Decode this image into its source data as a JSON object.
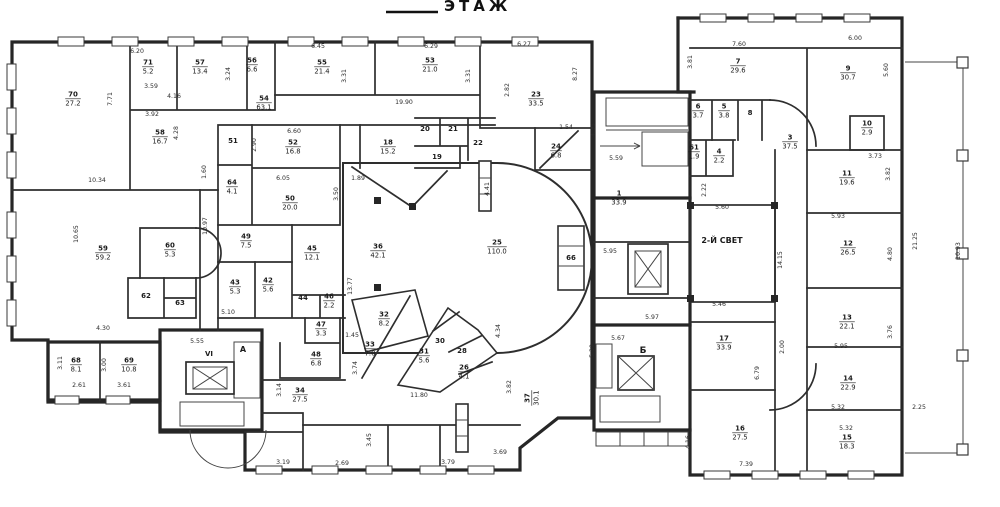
{
  "title": {
    "floor_label": "ЭТАЖ"
  },
  "colors": {
    "paper": "#ffffff",
    "ink": "#1b1b1b",
    "wall": "#262626"
  },
  "plan": {
    "annotation_note": "scanned floor plan; rooms are number/area fractions, dims in meters",
    "rooms": [
      {
        "n": "70",
        "a": "27.2",
        "x": 73,
        "y": 98
      },
      {
        "n": "71",
        "a": "5.2",
        "x": 148,
        "y": 66
      },
      {
        "n": "57",
        "a": "13.4",
        "x": 200,
        "y": 66
      },
      {
        "n": "56",
        "a": "6.6",
        "x": 252,
        "y": 64
      },
      {
        "n": "55",
        "a": "21.4",
        "x": 322,
        "y": 66
      },
      {
        "n": "53",
        "a": "21.0",
        "x": 430,
        "y": 64
      },
      {
        "n": "23",
        "a": "33.5",
        "x": 536,
        "y": 98
      },
      {
        "n": "54",
        "a": "63.1",
        "x": 264,
        "y": 102
      },
      {
        "n": "58",
        "a": "16.7",
        "x": 160,
        "y": 136
      },
      {
        "n": "51",
        "x": 233,
        "y": 140
      },
      {
        "n": "52",
        "a": "16.8",
        "x": 293,
        "y": 146
      },
      {
        "n": "18",
        "a": "15.2",
        "x": 388,
        "y": 146
      },
      {
        "n": "20",
        "x": 425,
        "y": 128
      },
      {
        "n": "21",
        "x": 453,
        "y": 128
      },
      {
        "n": "19",
        "x": 437,
        "y": 156
      },
      {
        "n": "22",
        "x": 478,
        "y": 142
      },
      {
        "n": "24",
        "a": "6.8",
        "x": 556,
        "y": 150
      },
      {
        "n": "64",
        "a": "4.1",
        "x": 232,
        "y": 186
      },
      {
        "n": "50",
        "a": "20.0",
        "x": 290,
        "y": 202
      },
      {
        "n": "49",
        "a": "7.5",
        "x": 246,
        "y": 240
      },
      {
        "n": "43",
        "a": "5.3",
        "x": 235,
        "y": 286
      },
      {
        "n": "42",
        "a": "5.6",
        "x": 268,
        "y": 284
      },
      {
        "n": "45",
        "a": "12.1",
        "x": 312,
        "y": 252
      },
      {
        "n": "44",
        "x": 303,
        "y": 297
      },
      {
        "n": "46",
        "a": "2.2",
        "x": 329,
        "y": 300
      },
      {
        "n": "47",
        "a": "3.3",
        "x": 321,
        "y": 328
      },
      {
        "n": "48",
        "a": "6.8",
        "x": 316,
        "y": 358
      },
      {
        "n": "36",
        "a": "42.1",
        "x": 378,
        "y": 250
      },
      {
        "n": "25",
        "a": "110.0",
        "x": 497,
        "y": 246
      },
      {
        "n": "59",
        "a": "59.2",
        "x": 103,
        "y": 252
      },
      {
        "n": "60",
        "a": "5.3",
        "x": 170,
        "y": 249
      },
      {
        "n": "62",
        "x": 146,
        "y": 295
      },
      {
        "n": "63",
        "x": 180,
        "y": 302
      },
      {
        "n": "68",
        "a": "8.1",
        "x": 76,
        "y": 364
      },
      {
        "n": "69",
        "a": "10.8",
        "x": 129,
        "y": 364
      },
      {
        "n": "34",
        "a": "27.5",
        "x": 300,
        "y": 394
      },
      {
        "n": "33",
        "a": "7.0",
        "x": 370,
        "y": 348
      },
      {
        "n": "32",
        "a": "8.2",
        "x": 384,
        "y": 318
      },
      {
        "n": "31",
        "a": "5.6",
        "x": 424,
        "y": 355
      },
      {
        "n": "30",
        "x": 440,
        "y": 340
      },
      {
        "n": "28",
        "x": 462,
        "y": 350
      },
      {
        "n": "26",
        "a": "4.1",
        "x": 464,
        "y": 371
      },
      {
        "n": "37",
        "a": "30.1",
        "x": 531,
        "y": 398,
        "r": -90
      },
      {
        "n": "66",
        "x": 571,
        "y": 257
      },
      {
        "n": "1",
        "a": "33.9",
        "x": 619,
        "y": 197
      },
      {
        "n": "17",
        "a": "33.9",
        "x": 724,
        "y": 342
      },
      {
        "n": "16",
        "a": "27.5",
        "x": 740,
        "y": 432
      },
      {
        "n": "7",
        "a": "29.6",
        "x": 738,
        "y": 65
      },
      {
        "n": "9",
        "a": "30.7",
        "x": 848,
        "y": 72
      },
      {
        "n": "6",
        "a": "3.7",
        "x": 698,
        "y": 110
      },
      {
        "n": "5",
        "a": "3.8",
        "x": 724,
        "y": 110
      },
      {
        "n": "8",
        "x": 750,
        "y": 112
      },
      {
        "n": "61",
        "a": "1.9",
        "x": 694,
        "y": 151
      },
      {
        "n": "4",
        "a": "2.2",
        "x": 719,
        "y": 155
      },
      {
        "n": "3",
        "a": "37.5",
        "x": 790,
        "y": 141
      },
      {
        "n": "10",
        "a": "2.9",
        "x": 867,
        "y": 127
      },
      {
        "n": "11",
        "a": "19.6",
        "x": 847,
        "y": 177
      },
      {
        "n": "12",
        "a": "26.5",
        "x": 848,
        "y": 247
      },
      {
        "n": "13",
        "a": "22.1",
        "x": 847,
        "y": 321
      },
      {
        "n": "14",
        "a": "22.9",
        "x": 848,
        "y": 382
      },
      {
        "n": "15",
        "a": "18.3",
        "x": 847,
        "y": 441
      }
    ],
    "dims": [
      {
        "t": "6.20",
        "x": 137,
        "y": 51
      },
      {
        "t": "3.59",
        "x": 151,
        "y": 86
      },
      {
        "t": "4.16",
        "x": 174,
        "y": 96
      },
      {
        "t": "3.92",
        "x": 152,
        "y": 114
      },
      {
        "t": "7.71",
        "x": 112,
        "y": 97,
        "r": -90
      },
      {
        "t": "4.28",
        "x": 178,
        "y": 131,
        "r": -90
      },
      {
        "t": "3.24",
        "x": 230,
        "y": 72,
        "r": -90
      },
      {
        "t": "6.45",
        "x": 318,
        "y": 46
      },
      {
        "t": "3.31",
        "x": 346,
        "y": 74,
        "r": -90
      },
      {
        "t": "6.29",
        "x": 431,
        "y": 46
      },
      {
        "t": "3.31",
        "x": 470,
        "y": 74,
        "r": -90
      },
      {
        "t": "6.27",
        "x": 524,
        "y": 44
      },
      {
        "t": "8.27",
        "x": 577,
        "y": 72,
        "r": -90
      },
      {
        "t": "19.90",
        "x": 404,
        "y": 102
      },
      {
        "t": "2.82",
        "x": 509,
        "y": 88,
        "r": -90
      },
      {
        "t": "1.54",
        "x": 566,
        "y": 127
      },
      {
        "t": "10.34",
        "x": 97,
        "y": 180
      },
      {
        "t": "10.65",
        "x": 78,
        "y": 232,
        "r": -90
      },
      {
        "t": "1.60",
        "x": 206,
        "y": 170,
        "r": -90
      },
      {
        "t": "6.60",
        "x": 294,
        "y": 131
      },
      {
        "t": "2.90",
        "x": 256,
        "y": 143,
        "r": -90
      },
      {
        "t": "6.05",
        "x": 283,
        "y": 178
      },
      {
        "t": "1.89",
        "x": 358,
        "y": 178
      },
      {
        "t": "3.50",
        "x": 338,
        "y": 192,
        "r": -90
      },
      {
        "t": "10.97",
        "x": 207,
        "y": 224,
        "r": -90
      },
      {
        "t": "13.77",
        "x": 352,
        "y": 284,
        "r": -90
      },
      {
        "t": "4.41",
        "x": 489,
        "y": 187,
        "r": -90
      },
      {
        "t": "1.45",
        "x": 352,
        "y": 335
      },
      {
        "t": "5.10",
        "x": 228,
        "y": 312
      },
      {
        "t": "4.30",
        "x": 103,
        "y": 328
      },
      {
        "t": "3.11",
        "x": 62,
        "y": 361,
        "r": -90
      },
      {
        "t": "3.00",
        "x": 106,
        "y": 363,
        "r": -90
      },
      {
        "t": "2.61",
        "x": 79,
        "y": 385
      },
      {
        "t": "3.61",
        "x": 124,
        "y": 385
      },
      {
        "t": "5.55",
        "x": 197,
        "y": 341
      },
      {
        "t": "3.14",
        "x": 281,
        "y": 388,
        "r": -90
      },
      {
        "t": "3.74",
        "x": 357,
        "y": 366,
        "r": -90
      },
      {
        "t": "11.80",
        "x": 419,
        "y": 395
      },
      {
        "t": "3.19",
        "x": 283,
        "y": 462
      },
      {
        "t": "2.69",
        "x": 342,
        "y": 463
      },
      {
        "t": "3.45",
        "x": 371,
        "y": 438,
        "r": -90
      },
      {
        "t": "3.79",
        "x": 448,
        "y": 462
      },
      {
        "t": "3.69",
        "x": 500,
        "y": 452
      },
      {
        "t": "4.34",
        "x": 500,
        "y": 329,
        "r": -90
      },
      {
        "t": "3.82",
        "x": 511,
        "y": 385,
        "r": -90
      },
      {
        "t": "4.35",
        "x": 595,
        "y": 128,
        "r": -90
      },
      {
        "t": "5.59",
        "x": 616,
        "y": 158
      },
      {
        "t": "5.95",
        "x": 610,
        "y": 251
      },
      {
        "t": "5.97",
        "x": 652,
        "y": 317
      },
      {
        "t": "2.22",
        "x": 706,
        "y": 188,
        "r": -90
      },
      {
        "t": "5.60",
        "x": 722,
        "y": 207
      },
      {
        "t": "5.46",
        "x": 719,
        "y": 304
      },
      {
        "t": "14.15",
        "x": 782,
        "y": 258,
        "r": -90
      },
      {
        "t": "5.67",
        "x": 618,
        "y": 338
      },
      {
        "t": "5.39",
        "x": 594,
        "y": 349,
        "r": -90
      },
      {
        "t": "4.16",
        "x": 690,
        "y": 440,
        "r": -90
      },
      {
        "t": "7.39",
        "x": 746,
        "y": 464
      },
      {
        "t": "6.79",
        "x": 759,
        "y": 371,
        "r": -90
      },
      {
        "t": "2.00",
        "x": 784,
        "y": 345,
        "r": -90
      },
      {
        "t": "7.60",
        "x": 739,
        "y": 44
      },
      {
        "t": "3.81",
        "x": 692,
        "y": 60,
        "r": -90
      },
      {
        "t": "6.00",
        "x": 855,
        "y": 38
      },
      {
        "t": "5.60",
        "x": 888,
        "y": 68,
        "r": -90
      },
      {
        "t": "3.73",
        "x": 875,
        "y": 156
      },
      {
        "t": "3.82",
        "x": 890,
        "y": 172,
        "r": -90
      },
      {
        "t": "5.93",
        "x": 838,
        "y": 216
      },
      {
        "t": "4.80",
        "x": 892,
        "y": 252,
        "r": -90
      },
      {
        "t": "21.25",
        "x": 917,
        "y": 239,
        "r": -90
      },
      {
        "t": "10.93",
        "x": 960,
        "y": 249,
        "r": -90
      },
      {
        "t": "3.76",
        "x": 892,
        "y": 330,
        "r": -90
      },
      {
        "t": "5.95",
        "x": 841,
        "y": 346
      },
      {
        "t": "5.32",
        "x": 838,
        "y": 407
      },
      {
        "t": "5.32",
        "x": 846,
        "y": 428
      },
      {
        "t": "2.25",
        "x": 919,
        "y": 407
      }
    ],
    "notes": [
      {
        "t": "2-Й СВЕТ",
        "x": 722,
        "y": 241,
        "s": 8
      },
      {
        "t": "Б",
        "x": 643,
        "y": 351,
        "s": 9
      },
      {
        "t": "VI",
        "x": 209,
        "y": 354,
        "s": 7
      },
      {
        "t": "А",
        "x": 243,
        "y": 350,
        "s": 8
      }
    ]
  }
}
